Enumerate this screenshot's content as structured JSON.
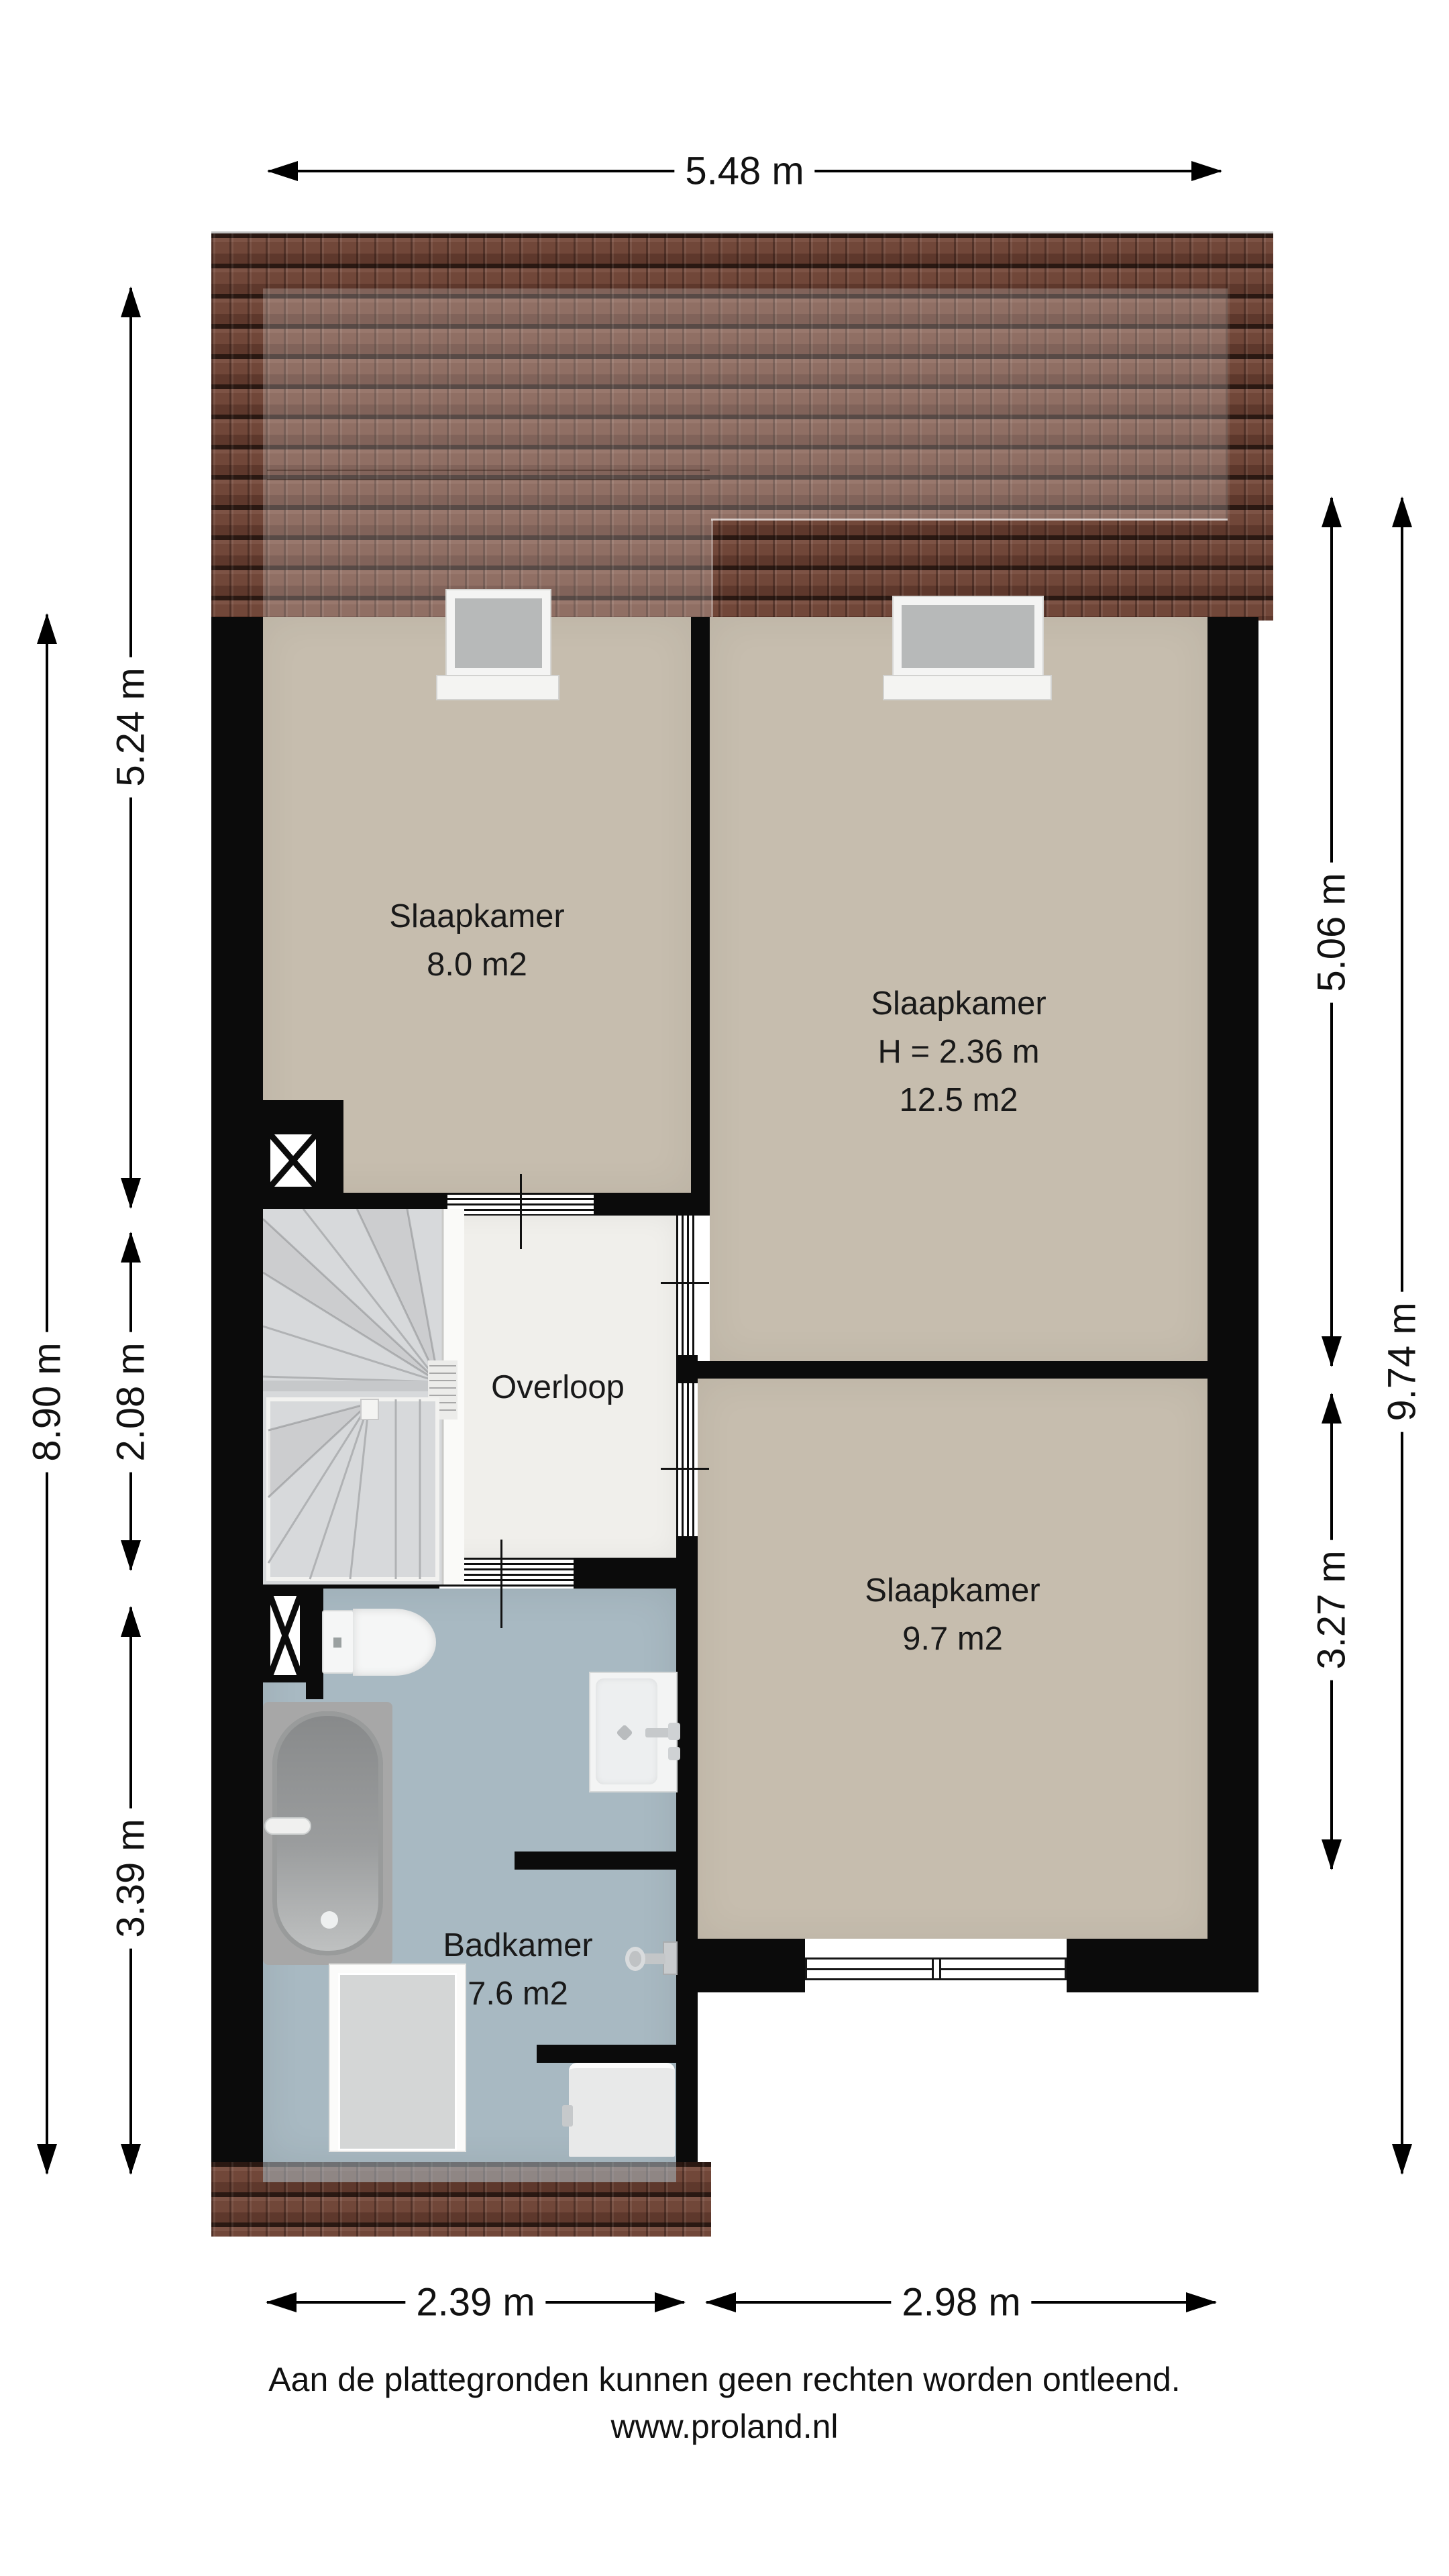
{
  "rooms": {
    "bedroom_small": {
      "label": "Slaapkamer",
      "area": "8.0 m2"
    },
    "bedroom_large": {
      "label": "Slaapkamer",
      "ceiling_height": "H = 2.36 m",
      "area": "12.5 m2"
    },
    "landing": {
      "label": "Overloop"
    },
    "bedroom_back": {
      "label": "Slaapkamer",
      "area": "9.7 m2"
    },
    "bathroom": {
      "label": "Badkamer",
      "area": "7.6 m2"
    }
  },
  "dimensions": {
    "top_width": "5.48 m",
    "left_total": "8.90 m",
    "left_upper": "5.24 m",
    "left_middle": "2.08 m",
    "left_lower": "3.39 m",
    "right_upper": "5.06 m",
    "right_lower": "3.27 m",
    "right_total": "9.74 m",
    "bottom_left": "2.39 m",
    "bottom_right": "2.98 m"
  },
  "footer": {
    "disclaimer": "Aan de plattegronden kunnen geen rechten worden ontleend.",
    "website": "www.proland.nl"
  },
  "colors": {
    "wall": "#0b0b0b",
    "bedroom_floor": "#c6bdae",
    "landing_floor": "#f0efeb",
    "bathroom_floor": "#a8b9c2",
    "roof_tile": "#6b4135",
    "roof_tile_dark": "#2a1812",
    "stair_tread": "#d7d9db",
    "fixture_white": "#f5f6f6",
    "dimension_text": "#111111"
  }
}
